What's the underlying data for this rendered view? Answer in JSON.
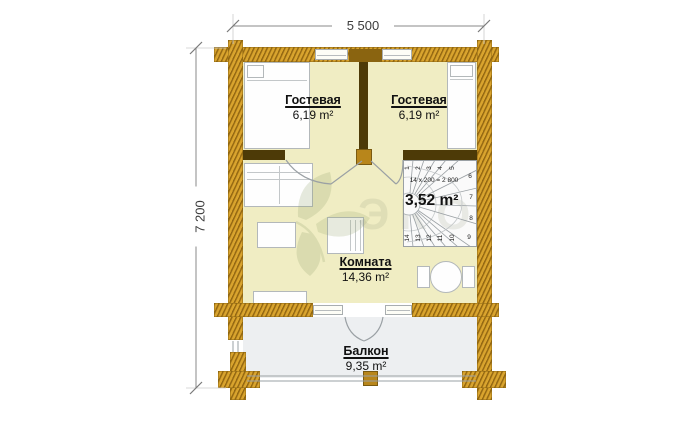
{
  "plan": {
    "type": "floor-plan",
    "dimensions": {
      "top": "5 500",
      "left": "7 200"
    },
    "rooms": {
      "guest_left": {
        "name": "Гостевая",
        "area": "6,19 m²"
      },
      "guest_right": {
        "name": "Гостевая",
        "area": "6,19 m²"
      },
      "living": {
        "name": "Комната",
        "area": "14,36 m²"
      },
      "balcony": {
        "name": "Балкон",
        "area": "9,35 m²"
      }
    },
    "stairs": {
      "area": "3,52 m²",
      "formula": "14 x 200 = 2 800",
      "steps": [
        "1",
        "2",
        "3",
        "4",
        "5",
        "6",
        "7",
        "8",
        "9",
        "10",
        "11",
        "12",
        "13",
        "14"
      ]
    },
    "watermark": {
      "text": "ЭКО"
    },
    "colors": {
      "wall_wood": "#c8931d",
      "wall_dark": "#4d3a07",
      "floor_room": "#f0edc3",
      "floor_balcony": "#edeff1"
    }
  }
}
